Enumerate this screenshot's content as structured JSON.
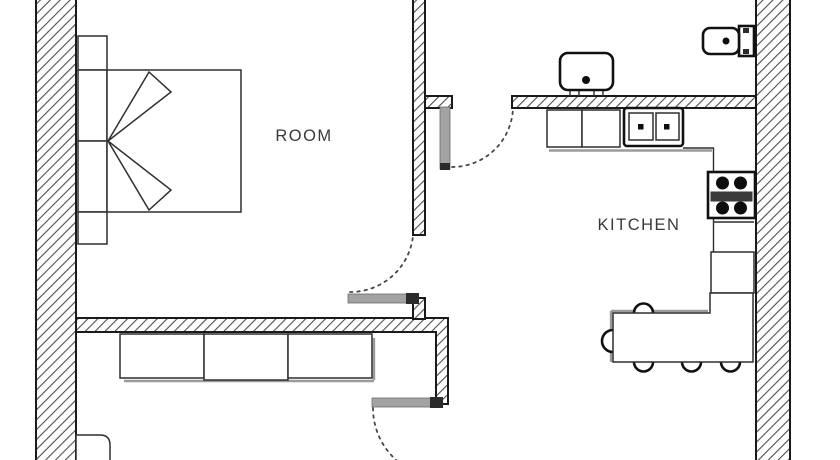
{
  "canvas": {
    "width": 840,
    "height": 460,
    "background": "#ffffff"
  },
  "labels": {
    "room": "ROOM",
    "kitchen": "KITCHEN"
  },
  "colors": {
    "wall_outline": "#1a1a1a",
    "hatch_line": "#4f4f4f",
    "furniture_line": "#2e2e2e",
    "appliance_black": "#0d0d0d",
    "shadow_gray": "#9b9b9b",
    "door_leaf_gray": "#a3a3a3",
    "label_text": "#3a3a3a",
    "background": "#ffffff"
  },
  "rooms": [
    {
      "id": "room",
      "label": "ROOM",
      "furniture": [
        "double-bed",
        "bed-pillows",
        "headboard-side-units"
      ]
    },
    {
      "id": "kitchen",
      "label": "KITCHEN",
      "furniture": [
        "base-cabinets",
        "double-basin-sink",
        "four-burner-stove",
        "counter-column",
        "dining-table",
        "five-chairs"
      ]
    },
    {
      "id": "bathroom",
      "furniture": [
        "wash-basin",
        "toilet"
      ]
    },
    {
      "id": "lower-room",
      "furniture": [
        "three-section-sideboard",
        "small-cabinet"
      ]
    }
  ],
  "doors": [
    {
      "id": "kitchen-hall-door",
      "type": "swing-arc"
    },
    {
      "id": "room-lower-door",
      "type": "swing-arc"
    },
    {
      "id": "lower-exit-door",
      "type": "swing-arc"
    }
  ]
}
